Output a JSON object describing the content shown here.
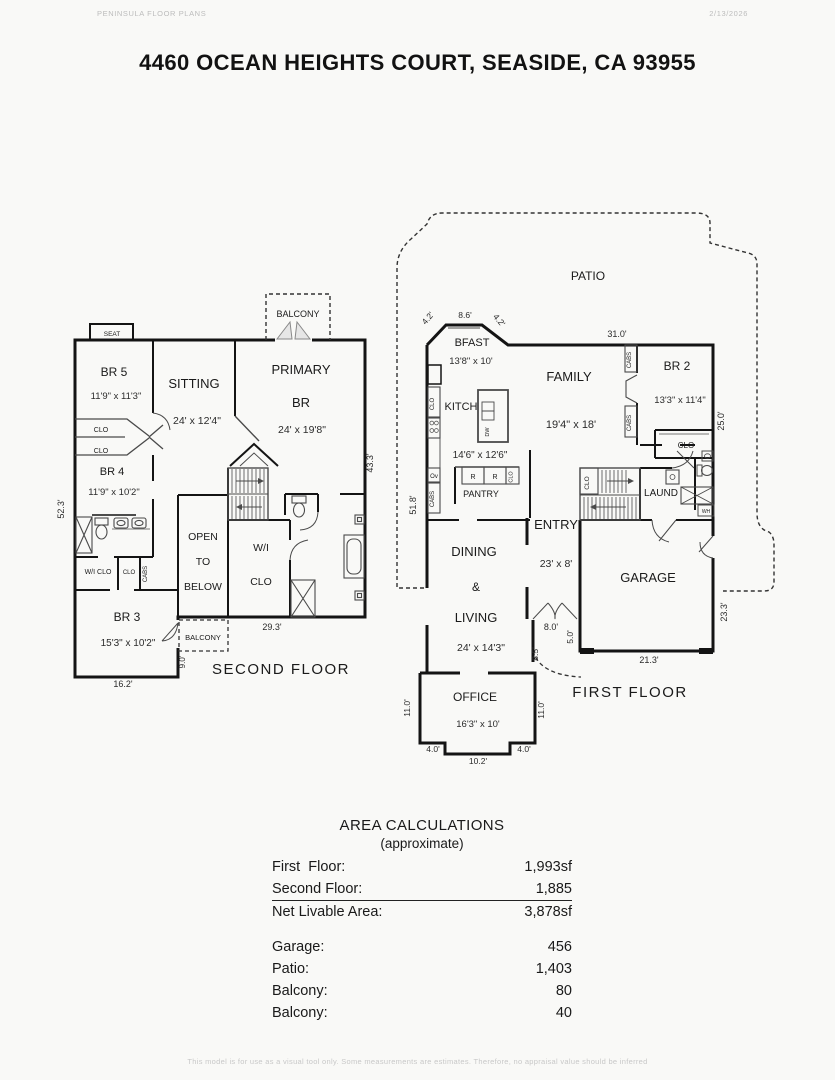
{
  "header": {
    "brand": "PENINSULA FLOOR PLANS",
    "date": "2/13/2026"
  },
  "title": "4460 OCEAN HEIGHTS COURT, SEASIDE, CA  93955",
  "sf": {
    "floor_label": "SECOND FLOOR",
    "balcony_top": "BALCONY",
    "seat": "SEAT",
    "br5": "BR 5",
    "br5_dim": "11'9\" x 11'3\"",
    "sitting": "SITTING",
    "sitting_dim": "24' x 12'4\"",
    "primary_l1": "PRIMARY",
    "primary_l2": "BR",
    "primary_dim": "24' x 19'8\"",
    "clo_a": "CLO",
    "clo_b": "CLO",
    "br4": "BR 4",
    "br4_dim": "11'9\" x 10'2\"",
    "wi_clo_small": "W/I CLO",
    "clo_c": "CLO",
    "cabs": "CABS",
    "br3": "BR 3",
    "br3_dim": "15'3\" x 10'2\"",
    "open_l1": "OPEN",
    "open_l2": "TO",
    "open_l3": "BELOW",
    "wi_l1": "W/I",
    "wi_l2": "CLO",
    "balcony_low": "BALCONY",
    "dim_left": "52.3'",
    "dim_right": "43.3'",
    "dim_293": "29.3'",
    "dim_90": "9.0'",
    "dim_162": "16.2'"
  },
  "ff": {
    "floor_label": "FIRST FLOOR",
    "patio": "PATIO",
    "dim_42a": "4.2'",
    "dim_86": "8.6'",
    "dim_42b": "4.2'",
    "dim_310": "31.0'",
    "bfast": "BFAST",
    "bfast_dim": "13'8\" x 10'",
    "kitch": "KITCH",
    "kitch_dim": "14'6\" x 12'6\"",
    "family": "FAMILY",
    "family_dim": "19'4\" x 18'",
    "br2": "BR 2",
    "br2_dim": "13'3\" x 11'4\"",
    "clo_kitchen": "CLO",
    "ov": "Ov",
    "cabs_left": "CABS",
    "dw": "DW",
    "fridge_a": "R",
    "fridge_b": "R",
    "clo_pantry": "CLO",
    "pantry": "PANTRY",
    "cabs_top": "CABS",
    "cabs_bottom": "CABS",
    "clo_br2": "CLO",
    "entry": "ENTRY",
    "entry_dim": "23' x 8'",
    "clo_stairs": "CLO",
    "laund": "LAUND",
    "wh": "WH",
    "dining": "DINING",
    "amp": "&",
    "living": "LIVING",
    "living_dim": "24' x 14'3\"",
    "garage": "GARAGE",
    "office": "OFFICE",
    "office_dim": "16'3\" x 10'",
    "dim_518": "51.8'",
    "dim_250": "25.0'",
    "dim_233": "23.3'",
    "dim_213": "21.3'",
    "dim_80": "8.0'",
    "dim_50": "5.0'",
    "dim_85": "8.5'",
    "dim_110a": "11.0'",
    "dim_110b": "11.0'",
    "dim_40a": "4.0'",
    "dim_40b": "4.0'",
    "dim_102": "10.2'"
  },
  "area": {
    "title": "AREA CALCULATIONS",
    "subtitle": "(approximate)",
    "rows": [
      {
        "label": "First  Floor:",
        "value": "1,993sf"
      },
      {
        "label": "Second Floor:",
        "value": "1,885"
      },
      {
        "label": "Net Livable Area:",
        "value": "3,878sf"
      }
    ],
    "rows2": [
      {
        "label": "Garage:",
        "value": "456"
      },
      {
        "label": "Patio:",
        "value": "1,403"
      },
      {
        "label": "Balcony:",
        "value": "80"
      },
      {
        "label": "Balcony:",
        "value": "40"
      }
    ]
  },
  "footer": "This model is for use as a visual tool only. Some measurements are estimates. Therefore, no appraisal value should be inferred"
}
